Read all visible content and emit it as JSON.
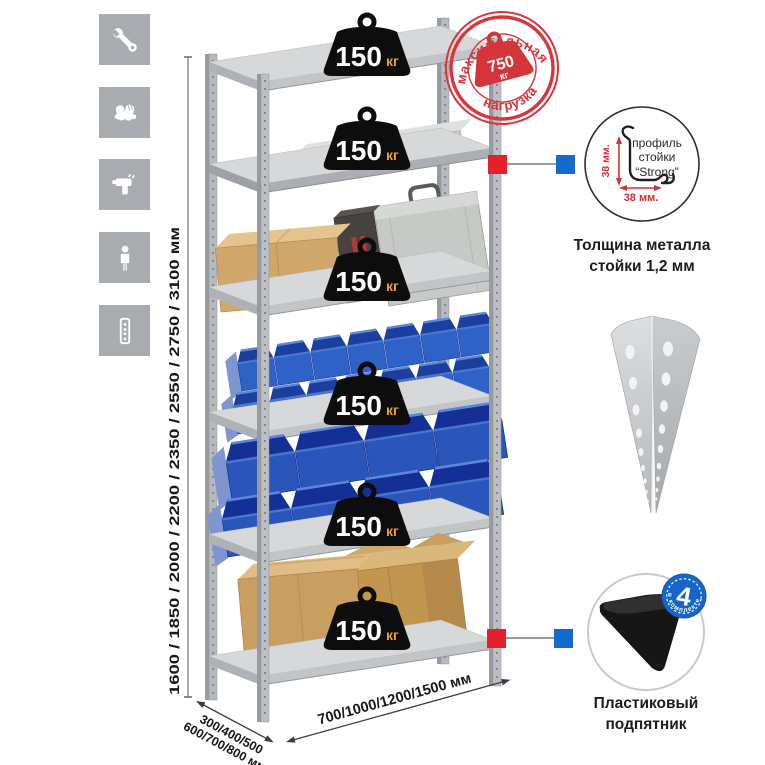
{
  "icons_panel": {
    "items": [
      {
        "icon": "wrench-icon"
      },
      {
        "icon": "gloves-icon"
      },
      {
        "icon": "drill-icon"
      },
      {
        "icon": "person-icon"
      },
      {
        "icon": "rack-post-icon"
      }
    ]
  },
  "dimensions": {
    "height_label": "1600 / 1850 / 2000 / 2200 / 2350 / 2550 / 2750 / 3100 мм",
    "depth_line1": "300/400/500",
    "depth_line2": "600/700/800 мм",
    "width_label": "700/1000/1200/1500 мм"
  },
  "shelf_loads": [
    {
      "value": "150",
      "unit": "кг"
    },
    {
      "value": "150",
      "unit": "кг"
    },
    {
      "value": "150",
      "unit": "кг"
    },
    {
      "value": "150",
      "unit": "кг"
    },
    {
      "value": "150",
      "unit": "кг"
    },
    {
      "value": "150",
      "unit": "кг"
    }
  ],
  "max_load_stamp": {
    "arc_top": "максимальная",
    "arc_bottom": "нагрузка",
    "value": "750",
    "unit": "кг"
  },
  "profile_detail": {
    "line1": "профиль",
    "line2": "стойки",
    "line3": "“Strong”",
    "dim_vertical": "38 мм.",
    "dim_horizontal": "38 мм.",
    "caption_line1": "Толщина металла",
    "caption_line2": "стойки 1,2 мм"
  },
  "foot_detail": {
    "badge_value": "4",
    "badge_arc": "в комплекте",
    "caption_line1": "Пластиковый",
    "caption_line2": "подпятник"
  },
  "colors": {
    "stamp_red": "#d8353c",
    "callout_red": "#e6212a",
    "callout_blue": "#156acd",
    "bin_blue_small": "#2e62c6",
    "bin_blue_large": "#2a56bc",
    "weight_black": "#0d0d0d",
    "unit_orange": "#f09a2e",
    "metal_light": "#d6d8da",
    "metal_mid": "#b4b7bb",
    "cardboard": "#cda367"
  }
}
